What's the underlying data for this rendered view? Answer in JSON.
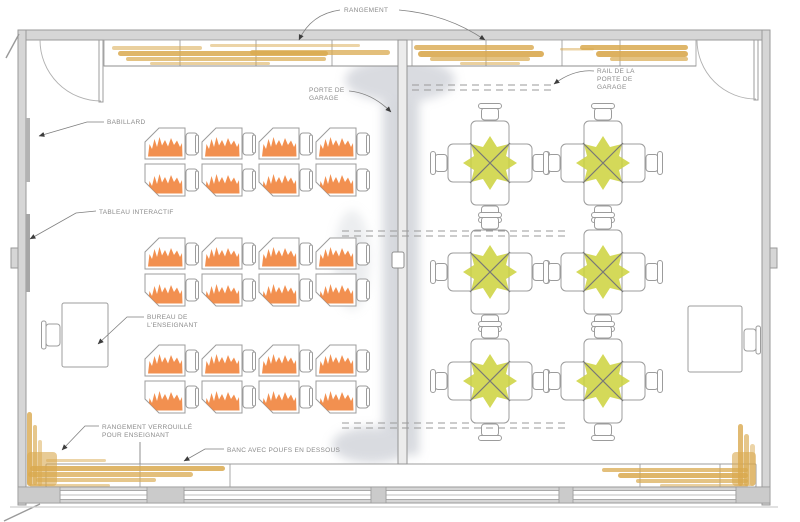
{
  "document": {
    "type": "classroom-floor-plan",
    "language": "fr"
  },
  "labels": {
    "rangement": {
      "lines": [
        "RANGEMENT"
      ]
    },
    "rail_porte_garage": {
      "lines": [
        "RAIL DE LA",
        "PORTE DE",
        "GARAGE"
      ]
    },
    "porte_garage": {
      "lines": [
        "PORTE DE",
        "GARAGE"
      ]
    },
    "babillard": {
      "lines": [
        "BABILLARD"
      ]
    },
    "tableau_interactif": {
      "lines": [
        "TABLEAU INTERACTIF"
      ]
    },
    "bureau_enseignant": {
      "lines": [
        "BUREAU DE",
        "L'ENSEIGNANT"
      ]
    },
    "rangement_verrouille": {
      "lines": [
        "RANGEMENT VERROUILLÉ",
        "POUR ENSEIGNANT"
      ]
    },
    "banc_poufs": {
      "lines": [
        "BANC AVEC POUFS EN DESSOUS"
      ]
    }
  },
  "colors": {
    "wall": "#d6d6d6",
    "wall_line": "#9a9a9a",
    "furniture_line": "#9c9c9c",
    "orange": "#f08138",
    "yellow_green": "#ccd23c",
    "wood_tan": "#d9a94f",
    "shadow_gray": "#b4b8c2",
    "label_text": "#8a8a8a"
  },
  "furniture": {
    "desk_pair_clusters": {
      "description": "pairs of pentagon student desks with chairs, orange finish",
      "count": 12,
      "columns_x": [
        145,
        202,
        259,
        316
      ],
      "rows_y": [
        128,
        238,
        345
      ]
    },
    "group_tables": {
      "description": "4-seat collaborative table groups, yellow-green finish",
      "count": 6,
      "seats_per_table": 4,
      "columns_x": [
        490,
        603
      ],
      "rows_y": [
        163,
        272,
        381
      ]
    },
    "teacher_desk": {
      "x": 62,
      "y": 303
    },
    "side_desk": {
      "x": 688,
      "y": 306
    }
  }
}
